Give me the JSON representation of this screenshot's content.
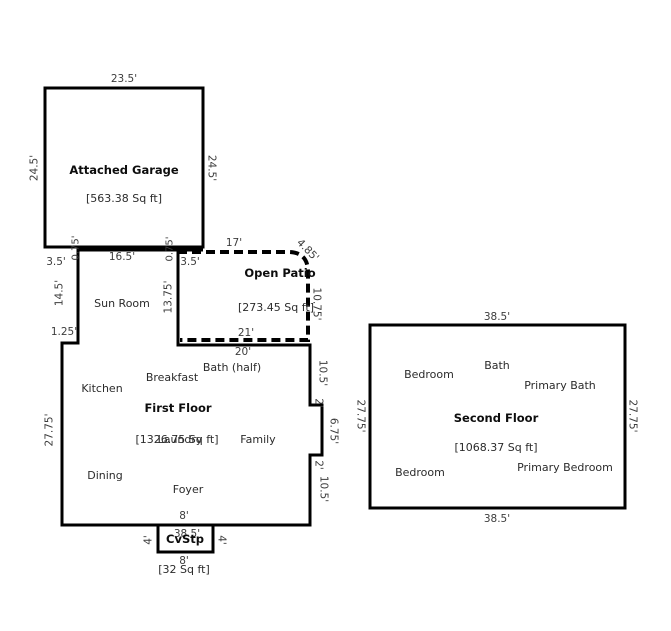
{
  "garage": {
    "name": "Attached Garage",
    "area": "[563.38 Sq ft]",
    "width_top": "23.5'",
    "height_left": "24.5'",
    "height_right": "24.5'"
  },
  "junction": {
    "gap_left": "3.5'",
    "offset_left": "0.75'",
    "width": "16.5'",
    "offset_right": "0.75'",
    "gap_right": "3.5'"
  },
  "sun_room": {
    "name": "Sun Room",
    "height_left": "14.5'",
    "height_right": "13.75'",
    "step": "1.25'"
  },
  "patio": {
    "name": "Open Patio",
    "area": "[273.45 Sq ft]",
    "width_top": "17'",
    "corner": "4.85'",
    "height_right": "10.75'",
    "width_bottom": "21'"
  },
  "first_floor": {
    "name": "First Floor",
    "area": "[1326.75 Sq ft]",
    "width_top": "20'",
    "height_left": "27.75'",
    "width_bottom": "38.5'",
    "stoop_width_inner": "8'",
    "right_side": [
      "10.5'",
      "2'",
      "6.75'",
      "2'",
      "10.5'"
    ],
    "rooms": {
      "kitchen": "Kitchen",
      "breakfast": "Breakfast",
      "bath_half": "Bath (half)",
      "laundry": "Laundry",
      "family": "Family",
      "dining": "Dining",
      "foyer": "Foyer"
    }
  },
  "stoop": {
    "name": "CvStp",
    "area": "[32 Sq ft]",
    "width_bottom": "8'",
    "side_left": "4'",
    "side_right": "4'"
  },
  "second_floor": {
    "name": "Second Floor",
    "area": "[1068.37 Sq ft]",
    "width_top": "38.5'",
    "width_bottom": "38.5'",
    "height_left": "27.75'",
    "height_right": "27.75'",
    "rooms": {
      "bedroom_top": "Bedroom",
      "bath": "Bath",
      "primary_bath": "Primary Bath",
      "bedroom_bottom": "Bedroom",
      "primary_bedroom": "Primary Bedroom"
    }
  },
  "colors": {
    "wall": "#000000",
    "text": "#3c3c3c",
    "background": "#ffffff"
  }
}
